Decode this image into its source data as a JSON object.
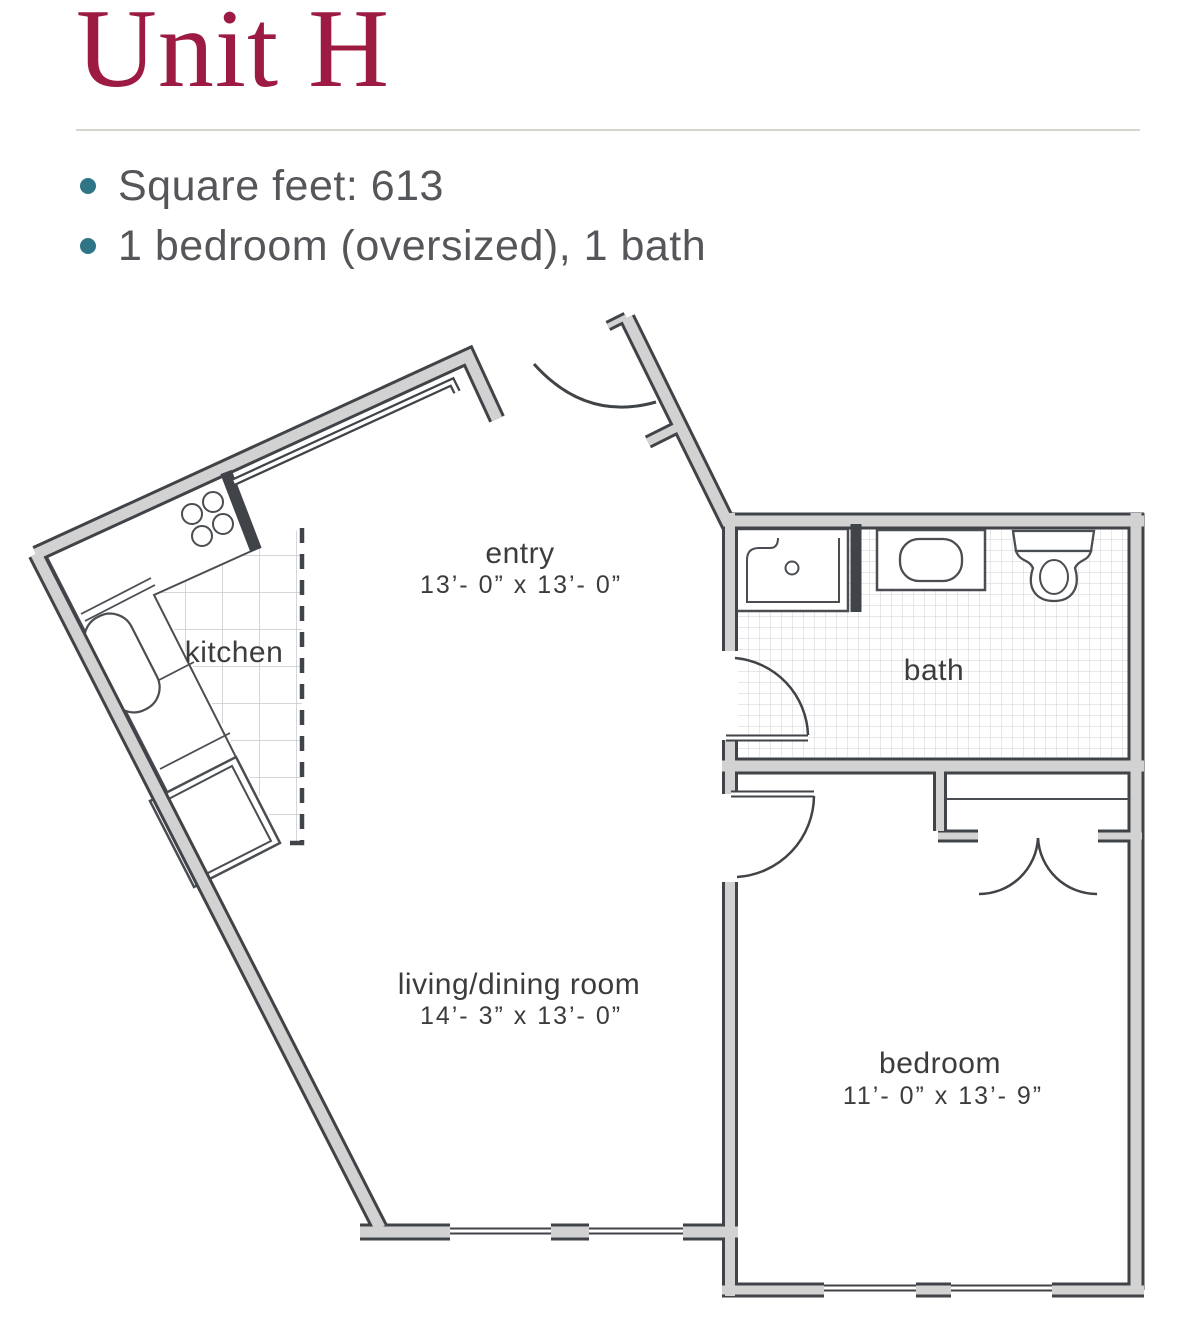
{
  "page": {
    "title": "Unit H"
  },
  "summary": {
    "items": [
      {
        "text": "Square feet: 613"
      },
      {
        "text": "1 bedroom (oversized), 1 bath"
      }
    ]
  },
  "floorplan": {
    "labels": {
      "entry": {
        "name": "entry",
        "dims": "13’- 0”  x  13’- 0”"
      },
      "kitchen": {
        "name": "kitchen"
      },
      "bath": {
        "name": "bath"
      },
      "living": {
        "name": "living/dining room",
        "dims": "14’- 3”  x  13’- 0”"
      },
      "bedroom": {
        "name": "bedroom",
        "dims": "11’- 0”  x  13’- 9”"
      }
    },
    "colors": {
      "wall_fill": "#d2d2d2",
      "wall_outline": "#404347",
      "title_accent": "#9d1b43",
      "bullet": "#2e7587",
      "text": "#55565a"
    }
  }
}
